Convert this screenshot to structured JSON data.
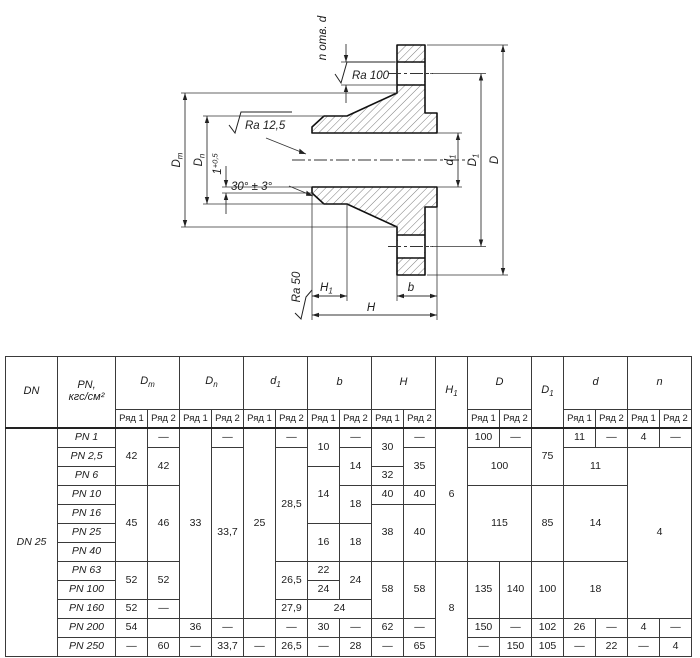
{
  "drawing": {
    "n_holes_label": "n отв. d",
    "roughness_top": "Ra 100",
    "roughness_mid": "Ra 12,5",
    "roughness_bottom": "Ra 50",
    "angle_note": "30° ± 3°",
    "dim_dm": {
      "main": "D",
      "sub": "m"
    },
    "dim_dn": {
      "main": "D",
      "sub": "n"
    },
    "dim_land": {
      "main": "1",
      "sup": "+0,5"
    },
    "dim_d1": {
      "main": "d",
      "sub": "1"
    },
    "dim_D1": {
      "main": "D",
      "sub": "1"
    },
    "dim_D": {
      "main": "D"
    },
    "dim_H1": {
      "main": "H",
      "sub": "1"
    },
    "dim_b": {
      "main": "b"
    },
    "dim_H": {
      "main": "H"
    }
  },
  "table": {
    "dn_label": "DN 25",
    "columns": [
      {
        "id": "dn",
        "label": "DN",
        "single": true
      },
      {
        "id": "pn",
        "label": "PN,",
        "label2": "кгс/см²",
        "single": true
      },
      {
        "id": "Dm",
        "label": "D",
        "sub": "m"
      },
      {
        "id": "Dn",
        "label": "D",
        "sub": "n"
      },
      {
        "id": "d1",
        "label": "d",
        "sub": "1"
      },
      {
        "id": "b",
        "label": "b"
      },
      {
        "id": "H",
        "label": "H"
      },
      {
        "id": "H1",
        "label": "H",
        "sub": "1",
        "single": true
      },
      {
        "id": "D",
        "label": "D"
      },
      {
        "id": "D1",
        "label": "D",
        "sub": "1",
        "single": true
      },
      {
        "id": "d",
        "label": "d"
      },
      {
        "id": "n",
        "label": "n"
      }
    ],
    "subheader": [
      "Ряд 1",
      "Ряд 2"
    ],
    "rows": [
      {
        "pn": "PN 1",
        "cells": [
          {
            "v": "42",
            "rs": 3
          },
          {
            "v": "—"
          },
          {
            "v": "33",
            "rs": 10
          },
          {
            "v": "—"
          },
          {
            "v": "25",
            "rs": 10
          },
          {
            "v": "—"
          },
          {
            "v": "10",
            "rs": 2
          },
          {
            "v": "—"
          },
          {
            "v": "30",
            "rs": 2
          },
          {
            "v": "—"
          },
          {
            "v": "6",
            "rs": 7
          },
          {
            "v": "100"
          },
          {
            "v": "—"
          },
          {
            "v": "75",
            "rs": 3
          },
          {
            "v": "11"
          },
          {
            "v": "—"
          },
          {
            "v": "4"
          },
          {
            "v": "—"
          }
        ]
      },
      {
        "pn": "PN 2,5",
        "cells": [
          {
            "v": "42",
            "rs": 2
          },
          {
            "v": "33,7",
            "rs": 9
          },
          {
            "v": "28,5",
            "rs": 6
          },
          {
            "v": "14",
            "rs": 2
          },
          {
            "v": "35",
            "rs": 2
          },
          {
            "v": "100",
            "rs": 2,
            "cs": 2
          },
          {
            "v": "11",
            "rs": 2,
            "cs": 2
          },
          {
            "v": "4",
            "rs": 9,
            "cs": 2
          }
        ]
      },
      {
        "pn": "PN 6",
        "cells": [
          {
            "v": "14",
            "rs": 3
          },
          {
            "v": "32"
          }
        ]
      },
      {
        "pn": "PN 10",
        "cells": [
          {
            "v": "45",
            "rs": 4
          },
          {
            "v": "46",
            "rs": 4
          },
          {
            "v": "18",
            "rs": 2
          },
          {
            "v": "40"
          },
          {
            "v": "40"
          },
          {
            "v": "115",
            "rs": 4,
            "cs": 2
          },
          {
            "v": "85",
            "rs": 4
          },
          {
            "v": "14",
            "rs": 4,
            "cs": 2
          }
        ]
      },
      {
        "pn": "PN 16",
        "cells": [
          {
            "v": "38",
            "rs": 3
          },
          {
            "v": "40",
            "rs": 3
          }
        ]
      },
      {
        "pn": "PN 25",
        "cells": [
          {
            "v": "16",
            "rs": 2
          },
          {
            "v": "18",
            "rs": 2
          }
        ]
      },
      {
        "pn": "PN 40",
        "cells": []
      },
      {
        "pn": "PN 63",
        "cells": [
          {
            "v": "52",
            "rs": 2
          },
          {
            "v": "52",
            "rs": 2
          },
          {
            "v": "26,5",
            "rs": 2
          },
          {
            "v": "22"
          },
          {
            "v": "24",
            "rs": 2
          },
          {
            "v": "58",
            "rs": 3
          },
          {
            "v": "58",
            "rs": 3
          },
          {
            "v": "8",
            "rs": 5
          },
          {
            "v": "135",
            "rs": 3
          },
          {
            "v": "140",
            "rs": 3
          },
          {
            "v": "100",
            "rs": 3
          },
          {
            "v": "18",
            "rs": 3,
            "cs": 2
          }
        ]
      },
      {
        "pn": "PN 100",
        "cells": [
          {
            "v": "24"
          }
        ]
      },
      {
        "pn": "PN 160",
        "cells": [
          {
            "v": "52"
          },
          {
            "v": "—"
          },
          {
            "v": "27,9"
          },
          {
            "v": "24",
            "cs": 2
          }
        ]
      },
      {
        "pn": "PN 200",
        "cells": [
          {
            "v": "54"
          },
          {
            "v": ""
          },
          {
            "v": "36"
          },
          {
            "v": "—"
          },
          {
            "v": ""
          },
          {
            "v": "—"
          },
          {
            "v": "30"
          },
          {
            "v": "—"
          },
          {
            "v": "62"
          },
          {
            "v": "—"
          },
          {
            "v": "150"
          },
          {
            "v": "—"
          },
          {
            "v": "102"
          },
          {
            "v": "26"
          },
          {
            "v": "—"
          },
          {
            "v": "4"
          },
          {
            "v": "—"
          }
        ]
      },
      {
        "pn": "PN 250",
        "cells": [
          {
            "v": "—"
          },
          {
            "v": "60"
          },
          {
            "v": "—"
          },
          {
            "v": "33,7"
          },
          {
            "v": "—"
          },
          {
            "v": "26,5"
          },
          {
            "v": "—"
          },
          {
            "v": "28"
          },
          {
            "v": "—"
          },
          {
            "v": "65"
          },
          {
            "v": "—"
          },
          {
            "v": "150"
          },
          {
            "v": "105"
          },
          {
            "v": "—"
          },
          {
            "v": "22"
          },
          {
            "v": "—"
          },
          {
            "v": "4"
          }
        ]
      }
    ]
  }
}
